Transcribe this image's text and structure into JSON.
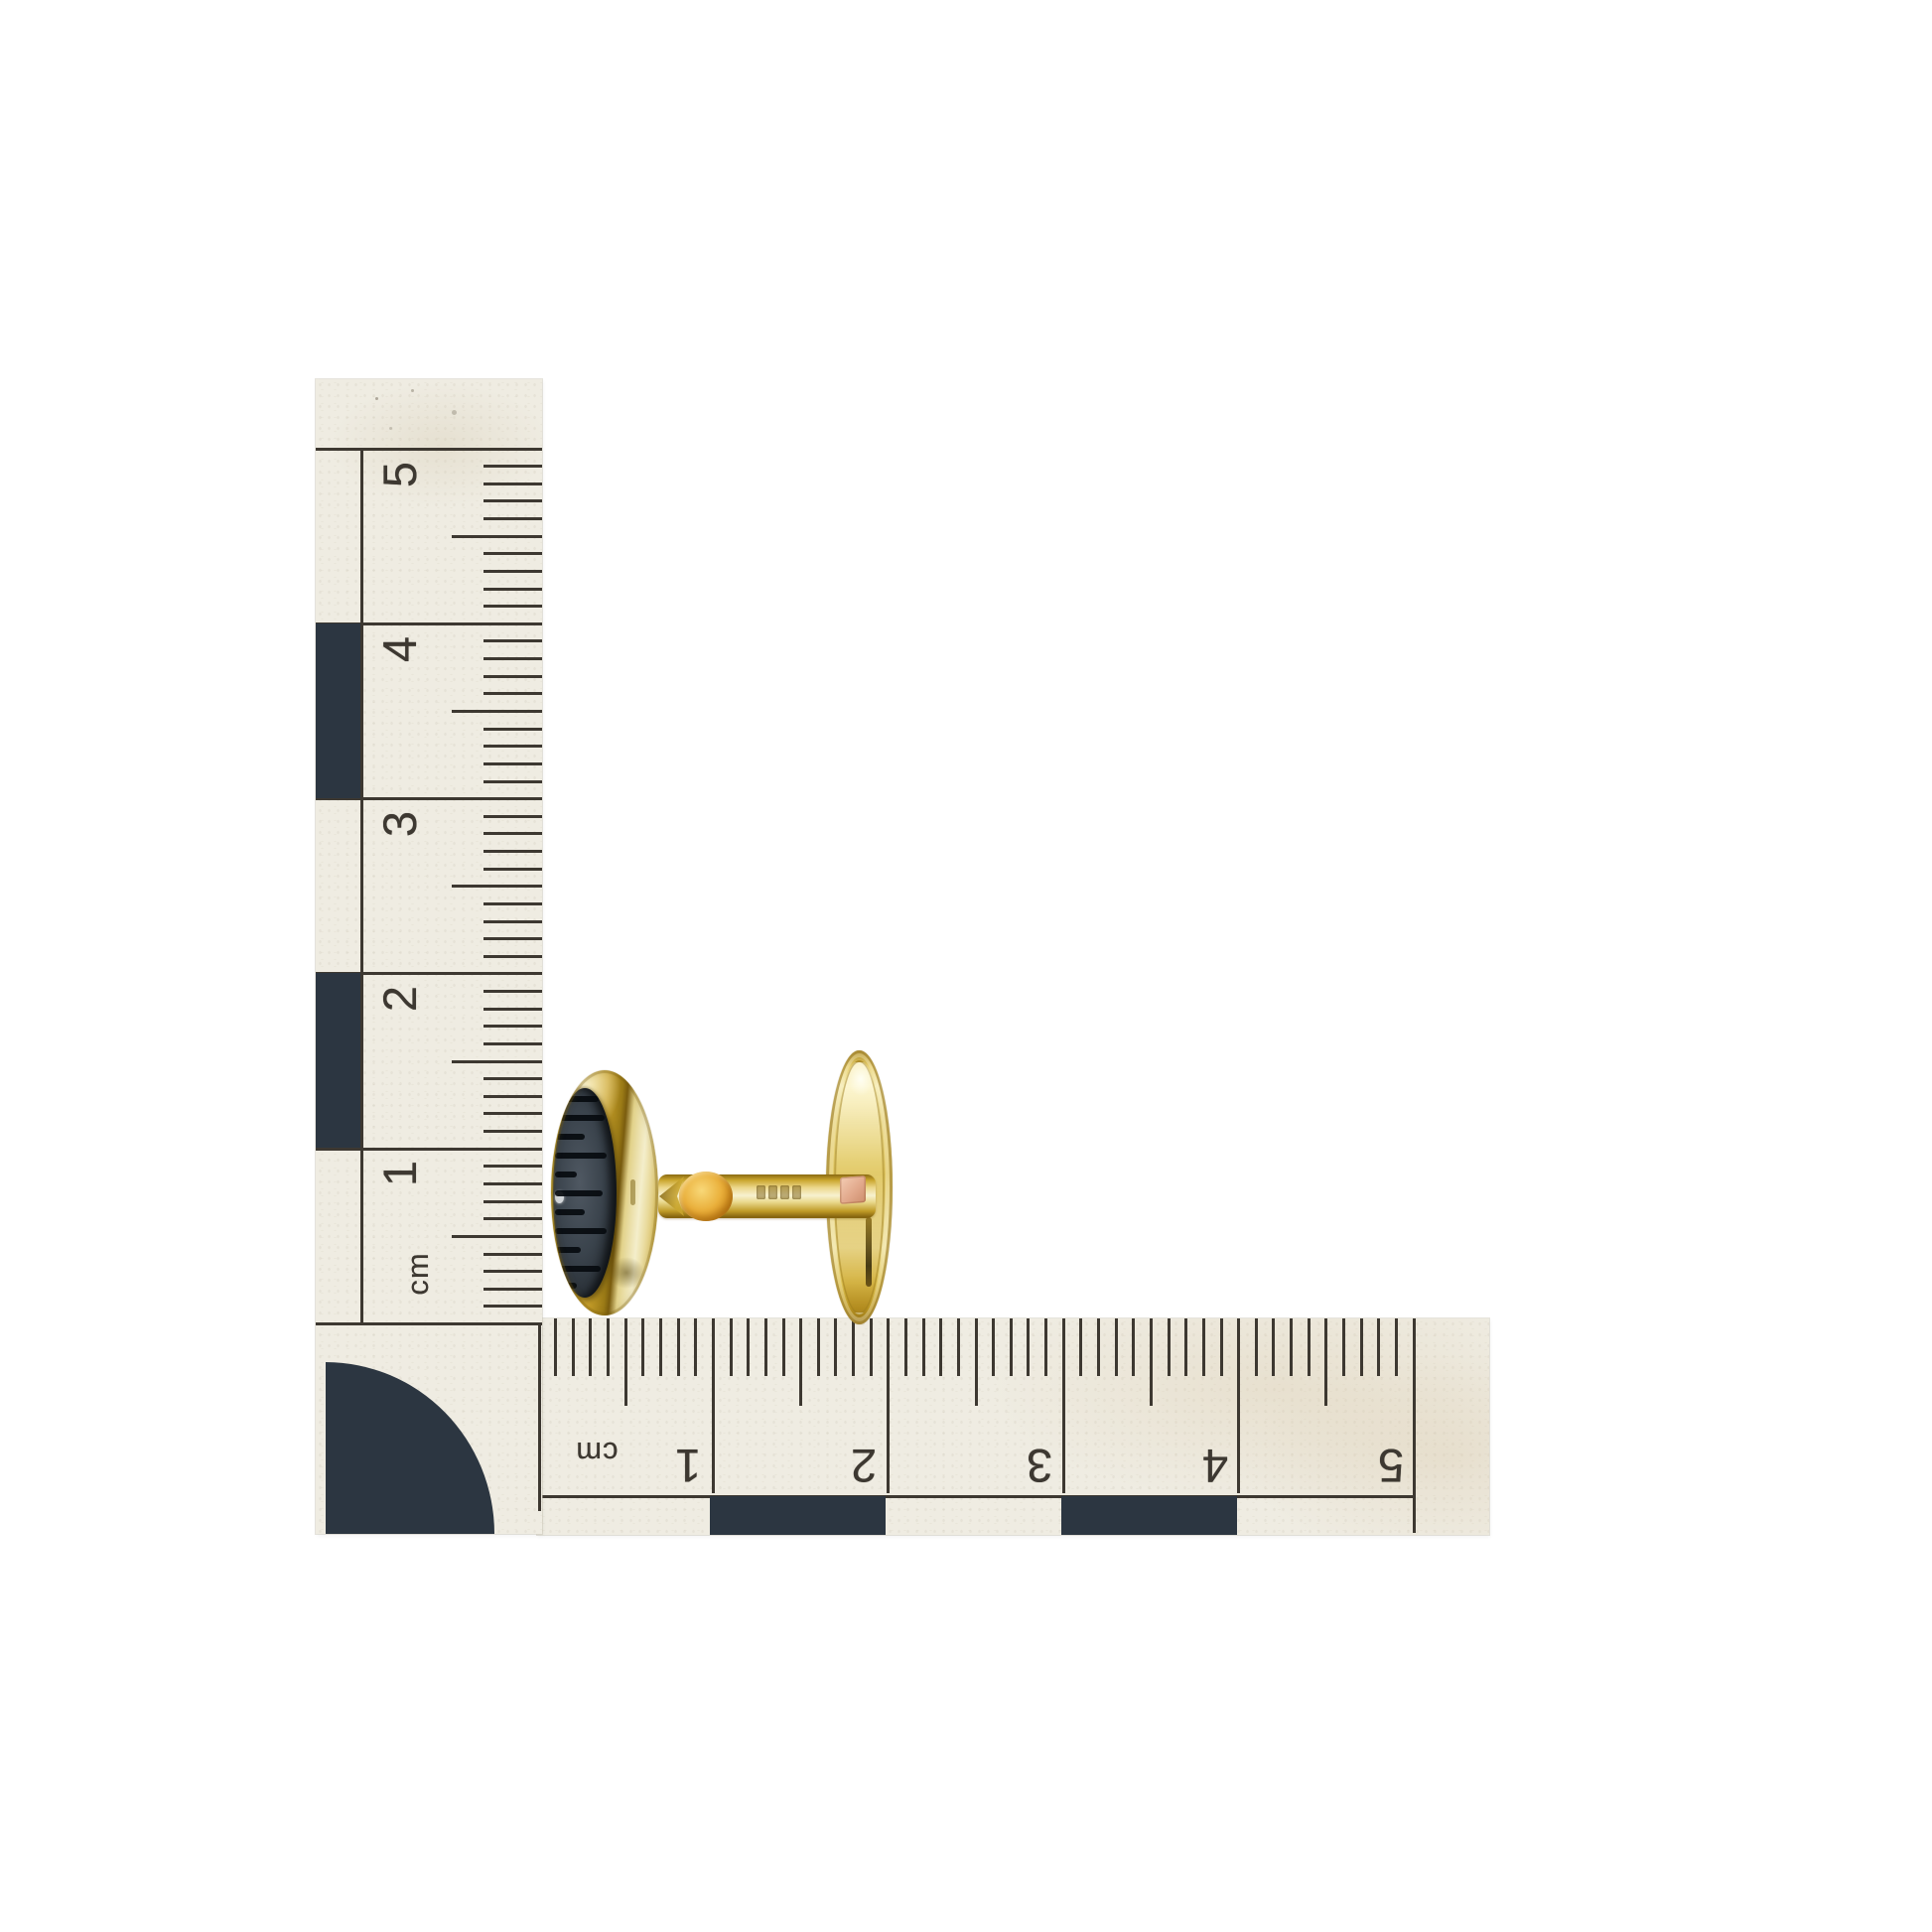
{
  "scene": {
    "background_color": "#ffffff",
    "subject": "gold cufflink with dark striped oval stone beside two centimetre scale rulers"
  },
  "rulers": {
    "vertical": {
      "unit_label": "cm",
      "labels": [
        "5",
        "4",
        "3",
        "2",
        "1"
      ]
    },
    "horizontal": {
      "unit_label": "cm",
      "labels": [
        "1",
        "2",
        "3",
        "4",
        "5"
      ]
    }
  },
  "colors": {
    "background": "#ffffff",
    "paper": "#efece2",
    "ink": "#3d3831",
    "checker": "#2c3641",
    "gold": "#d9b73c",
    "gold_pale": "#f2ebc4",
    "gold_deep": "#8a6a12",
    "amber": "#e09a28",
    "stone": "#39424b",
    "stone_stripe": "#070b0f",
    "hallmark_pink": "#e2ad93"
  }
}
